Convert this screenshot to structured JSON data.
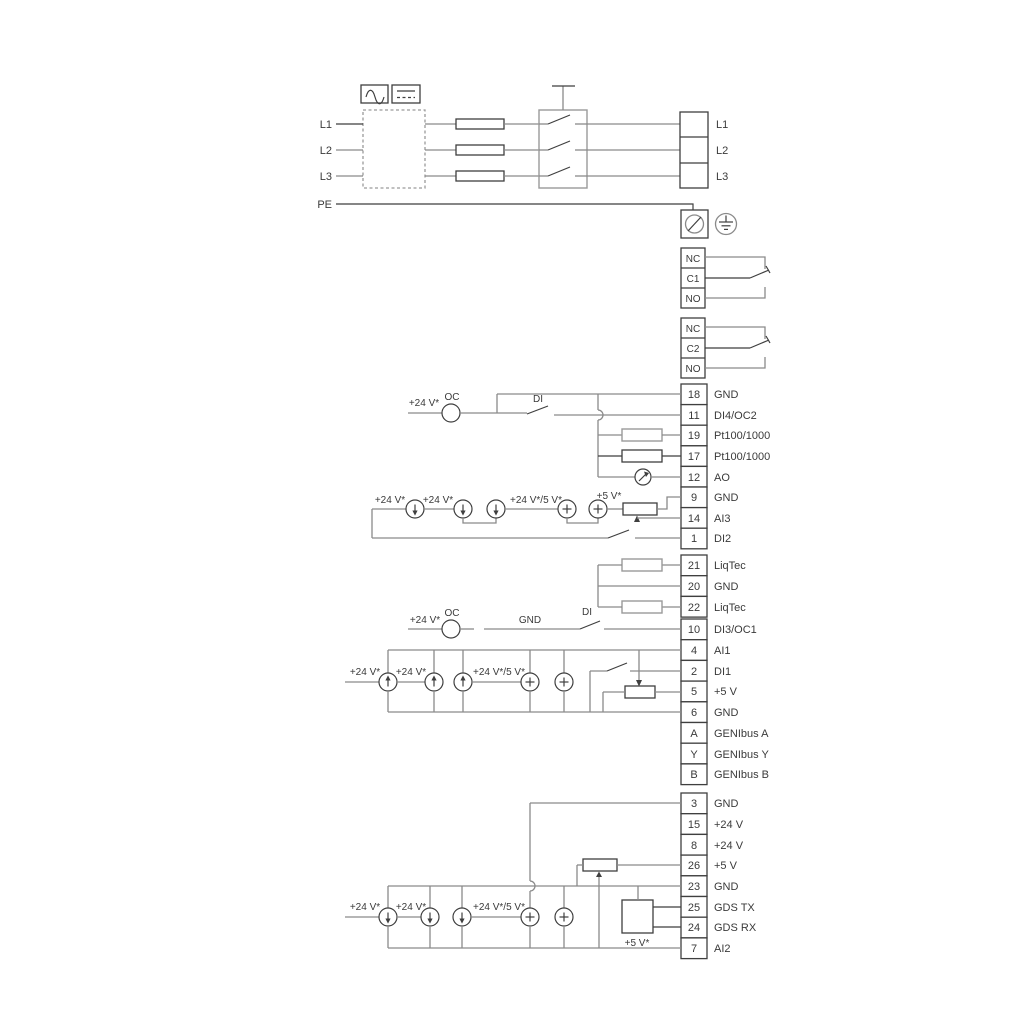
{
  "ann": {
    "v24": "+24 V*",
    "v24or5": "+24 V*/5 V*",
    "v5": "+5 V*",
    "oc": "OC",
    "di": "DI",
    "gnd": "GND"
  },
  "mains": {
    "inputs": [
      "L1",
      "L2",
      "L3",
      "PE"
    ],
    "outputs": [
      "L1",
      "L2",
      "L3"
    ]
  },
  "relays": [
    {
      "terminals": [
        "NC",
        "C1",
        "NO"
      ]
    },
    {
      "terminals": [
        "NC",
        "C2",
        "NO"
      ]
    }
  ],
  "strip_a": [
    {
      "no": "18",
      "label": "GND"
    },
    {
      "no": "11",
      "label": "DI4/OC2"
    },
    {
      "no": "19",
      "label": "Pt100/1000"
    },
    {
      "no": "17",
      "label": "Pt100/1000"
    },
    {
      "no": "12",
      "label": "AO"
    },
    {
      "no": "9",
      "label": "GND"
    },
    {
      "no": "14",
      "label": "AI3"
    },
    {
      "no": "1",
      "label": "DI2"
    }
  ],
  "strip_b": [
    {
      "no": "21",
      "label": "LiqTec"
    },
    {
      "no": "20",
      "label": "GND"
    },
    {
      "no": "22",
      "label": "LiqTec"
    }
  ],
  "strip_c": [
    {
      "no": "10",
      "label": "DI3/OC1"
    },
    {
      "no": "4",
      "label": "AI1"
    },
    {
      "no": "2",
      "label": "DI1"
    },
    {
      "no": "5",
      "label": "+5 V"
    },
    {
      "no": "6",
      "label": "GND"
    },
    {
      "no": "A",
      "label": "GENIbus A"
    },
    {
      "no": "Y",
      "label": "GENIbus Y"
    },
    {
      "no": "B",
      "label": "GENIbus B"
    }
  ],
  "strip_d": [
    {
      "no": "3",
      "label": "GND"
    },
    {
      "no": "15",
      "label": "+24 V"
    },
    {
      "no": "8",
      "label": "+24 V"
    },
    {
      "no": "26",
      "label": "+5 V"
    },
    {
      "no": "23",
      "label": "GND"
    },
    {
      "no": "25",
      "label": "GDS TX"
    },
    {
      "no": "24",
      "label": "GDS RX"
    },
    {
      "no": "7",
      "label": "AI2"
    }
  ],
  "colors": {
    "wire_gray": "#8a8a8a",
    "wire_dark": "#3f3f3f",
    "text": "#3a3a3a"
  }
}
